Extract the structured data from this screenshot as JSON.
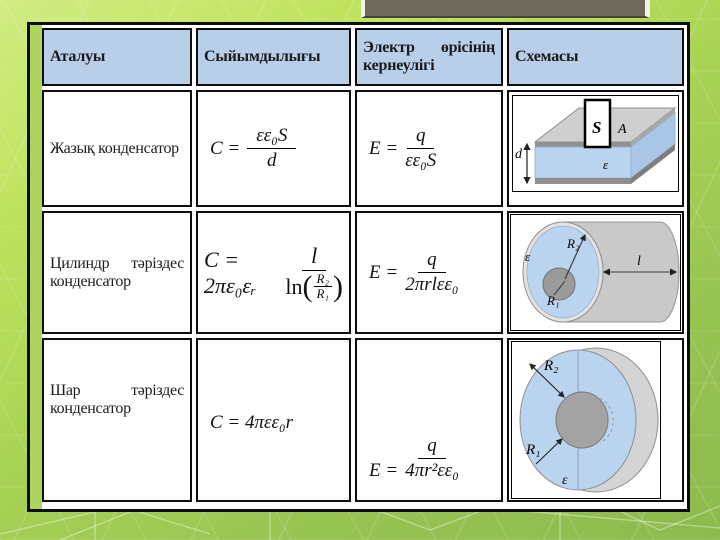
{
  "table": {
    "headers": {
      "name": "Аталуы",
      "capacitance": "Сыйымдылығы",
      "field_line1_left": "Электр",
      "field_line1_right": "өрісінің",
      "field_line2": "кернеулігі",
      "schematic": "Схемасы"
    },
    "rows": [
      {
        "name": "Жазық конденсатор",
        "cap": {
          "lhs": "C =",
          "num": "εε₀S",
          "den": "d"
        },
        "field": {
          "lhs": "E =",
          "num": "q",
          "den": "εε₀S"
        },
        "diagram": {
          "d": "d",
          "S": "S",
          "A": "A",
          "eps": "ε"
        }
      },
      {
        "name_w1": "Цилиндр",
        "name_w2": "тәріздес",
        "name_line2": "конденсатор",
        "cap": {
          "lhs": "C = 2πε₀εᵣ",
          "num": "l",
          "den_fn": "ln",
          "den_open": "(",
          "den_num": "R₂",
          "den_den": "R₁",
          "den_close": ")"
        },
        "field": {
          "lhs": "E =",
          "num": "q",
          "den": "2πrlεε₀"
        },
        "diagram": {
          "eps": "ε",
          "R2": "R₂",
          "R1": "R₁",
          "l": "l"
        }
      },
      {
        "name_w1": "Шар",
        "name_w2": "тәріздес",
        "name_line2": "конденсатор",
        "cap_text": "C = 4πεε₀r",
        "field": {
          "lhs": "E =",
          "num": "q",
          "den": "4πr²εε₀"
        },
        "diagram": {
          "R2": "R₂",
          "R1": "R₁",
          "eps": "ε"
        }
      }
    ]
  },
  "colors": {
    "header_fill": "#b9cfe9",
    "dielectric_blue": "#bad3ee",
    "metal_gray": "#c9c9c9",
    "top_bar": "#6f695c",
    "slide_green": "#a4cf55"
  }
}
